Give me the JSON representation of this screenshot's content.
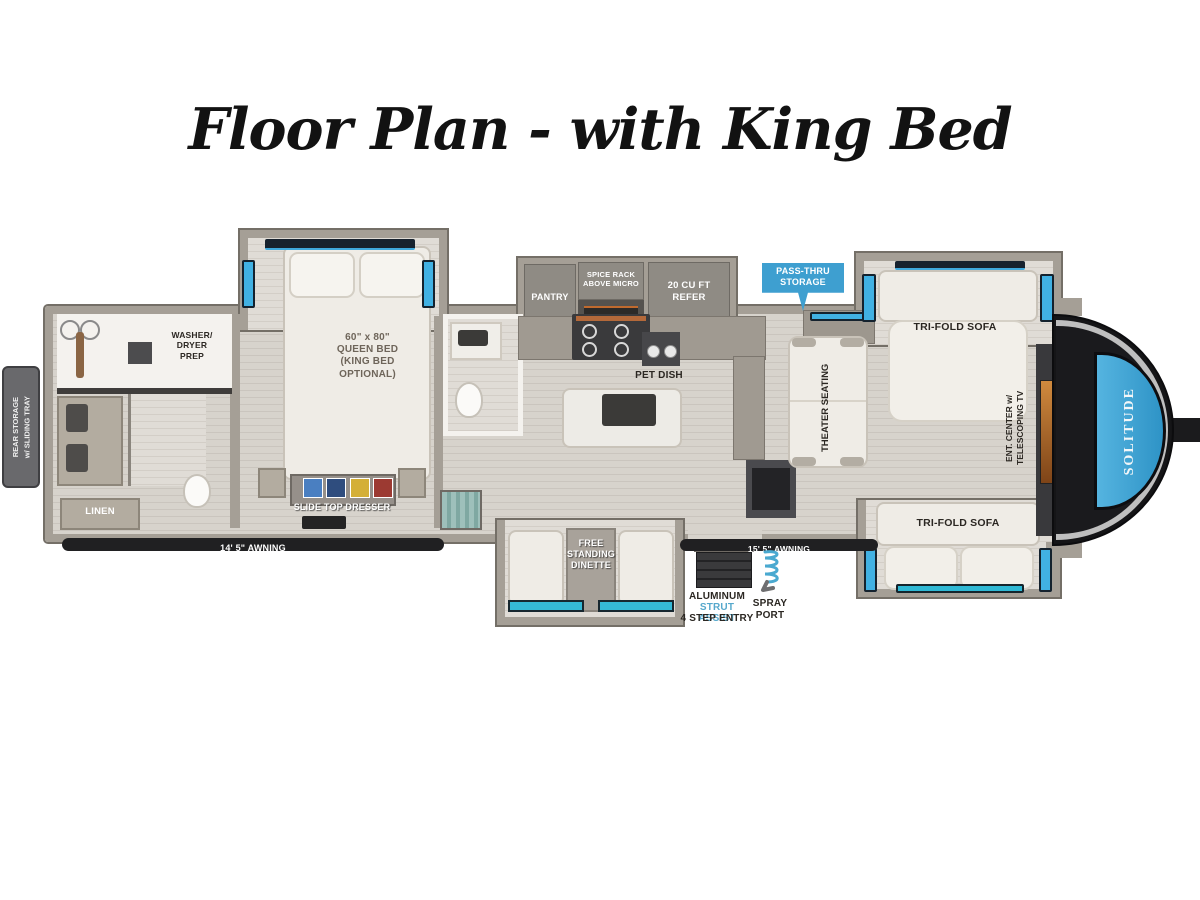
{
  "title": "Floor Plan - with King Bed",
  "exterior": {
    "rear_storage": "REAR STORAGE\nw/ SLIDING TRAY",
    "awning_left": "14' 5\" AWNING",
    "awning_right": "15' 5\" AWNING",
    "pass_thru_storage": "PASS-THRU\nSTORAGE",
    "entry_material": "ALUMINUM",
    "entry_strut": "STRUT ASSIST",
    "entry_steps": "4 STEP ENTRY",
    "spray_port": "SPRAY\nPORT",
    "brand": "SOLITUDE"
  },
  "bedroom": {
    "bed": "60\" x 80\"\nQUEEN BED\n(KING BED\nOPTIONAL)",
    "dresser": "SLIDE TOP DRESSER",
    "washer_dryer": "WASHER/\nDRYER\nPREP",
    "linen": "LINEN"
  },
  "kitchen": {
    "pantry": "PANTRY",
    "spice_rack": "SPICE RACK\nABOVE MICRO",
    "refrigerator": "20 CU FT\nREFER",
    "pet_dish": "PET DISH",
    "dinette": "FREE\nSTANDING\nDINETTE"
  },
  "living": {
    "sofa_top": "TRI-FOLD SOFA",
    "sofa_bottom": "TRI-FOLD SOFA",
    "theater_seating": "THEATER SEATING",
    "ent_center": "ENT. CENTER w/\nTELESCOPING TV"
  },
  "colors": {
    "window_blue": "#45b4e6",
    "banner_blue": "#3e9fd0",
    "brand_panel_blue": "#3fa3d5",
    "strut_text_blue": "#56a8cc"
  }
}
